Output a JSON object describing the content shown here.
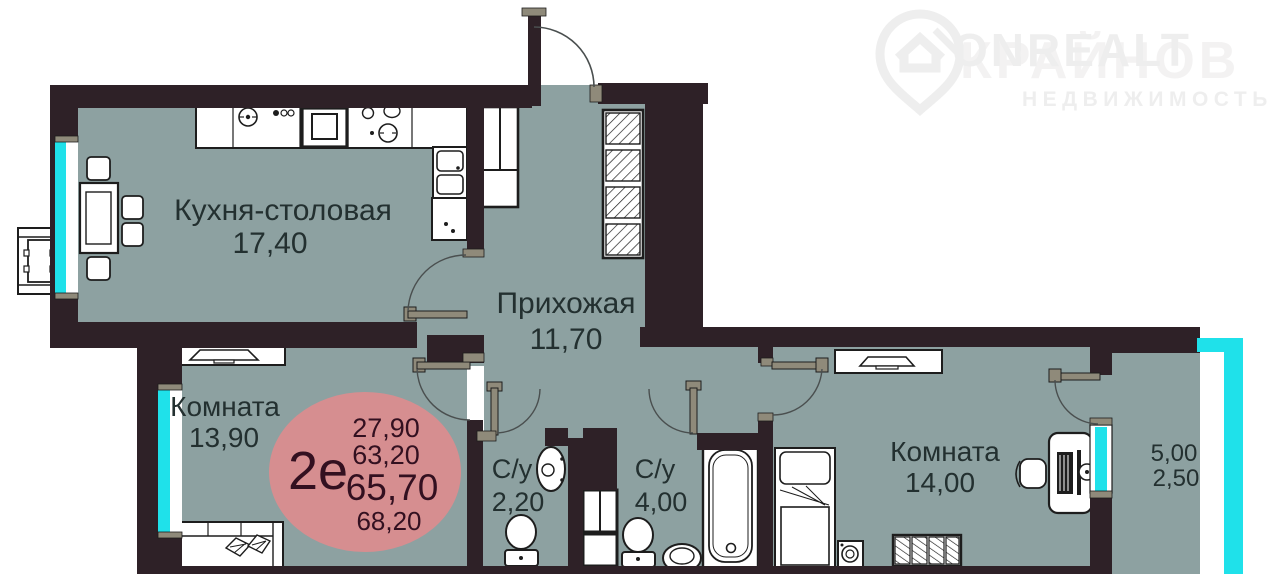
{
  "watermark": {
    "brand": "ONREALT",
    "agency": "КРАЙНОВ",
    "category": "НЕДВИЖИМОСТЬ"
  },
  "badge": {
    "type_label": "2е",
    "area_1": "27,90",
    "area_2": "63,20",
    "area_3": "65,70",
    "area_4": "68,20",
    "color": "#d68e90"
  },
  "rooms": {
    "kitchen": {
      "name": "Кухня-столовая",
      "area": "17,40"
    },
    "hall": {
      "name": "Прихожая",
      "area": "11,70"
    },
    "room1": {
      "name": "Комната",
      "area": "13,90"
    },
    "room2": {
      "name": "Комната",
      "area": "14,00"
    },
    "wc_small": {
      "name": "С/у",
      "area": "2,20"
    },
    "wc_big": {
      "name": "С/у",
      "area": "4,00"
    },
    "balcony": {
      "area_full": "5,00",
      "area_reduced": "2,50"
    }
  },
  "colors": {
    "wall": "#2e2127",
    "floor": "#8da1a1",
    "window_glass": "#1fe1ea",
    "door_leaf": "#8f8a7a",
    "badge_fill": "#d68e90"
  }
}
